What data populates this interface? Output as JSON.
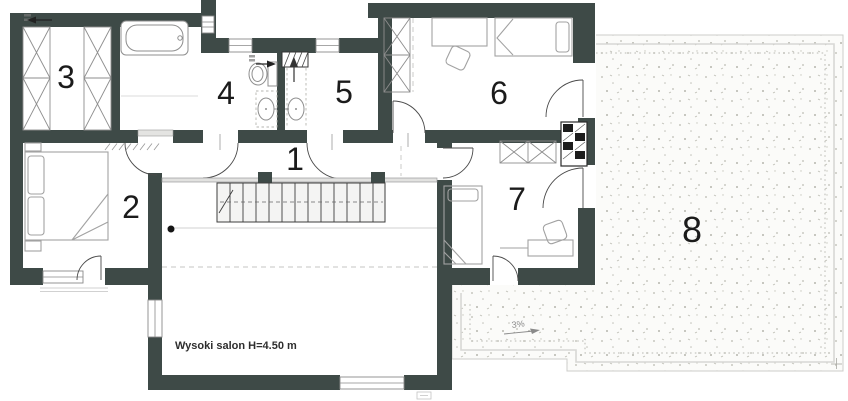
{
  "floorplan": {
    "room_numbers": [
      "1",
      "2",
      "3",
      "4",
      "5",
      "6",
      "7",
      "8"
    ],
    "annotations": {
      "salon_note": "Wysoki salon H=4.50 m",
      "terrace_slope": "3%"
    },
    "colors": {
      "wall": "#3E4A47",
      "furniture_line": "#A2A2A2",
      "terrace_speckle": "#B8B8AF",
      "background": "#FFFFFF"
    }
  }
}
